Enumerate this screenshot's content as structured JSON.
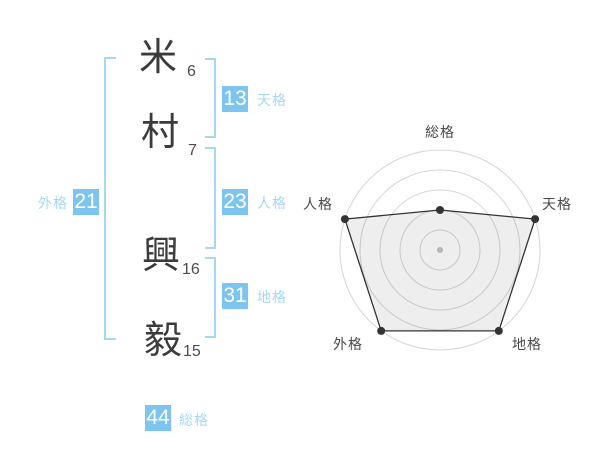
{
  "name": {
    "family": [
      {
        "char": "米",
        "strokes": "6"
      },
      {
        "char": "村",
        "strokes": "7"
      }
    ],
    "given": [
      {
        "char": "興",
        "strokes": "16"
      },
      {
        "char": "毅",
        "strokes": "15"
      }
    ]
  },
  "categories": {
    "tenkaku": {
      "label": "天格",
      "value": "13"
    },
    "jinkaku": {
      "label": "人格",
      "value": "23"
    },
    "chikaku": {
      "label": "地格",
      "value": "31"
    },
    "gaikaku": {
      "label": "外格",
      "value": "21"
    },
    "soukaku": {
      "label": "総格",
      "value": "44"
    }
  },
  "colors": {
    "badge_blue": "#7dc5ee",
    "light_blue": "#a6d8f4",
    "ink": "#3b3b3b",
    "number_grey": "#4d4d4d",
    "grid_grey": "#d6d6d6",
    "radar_dark": "#333333",
    "center_dot_grey": "#c3c3c3"
  },
  "chart_data": {
    "type": "radar",
    "title": "",
    "axes": [
      "総格",
      "天格",
      "地格",
      "外格",
      "人格"
    ],
    "values": [
      2,
      5,
      5,
      5,
      5
    ],
    "max": 5,
    "rings": 5,
    "grid": "concentric-circles",
    "legend": "none",
    "category_scores": {
      "総格": "44",
      "天格": "13",
      "地格": "31",
      "外格": "21",
      "人格": "23"
    }
  }
}
